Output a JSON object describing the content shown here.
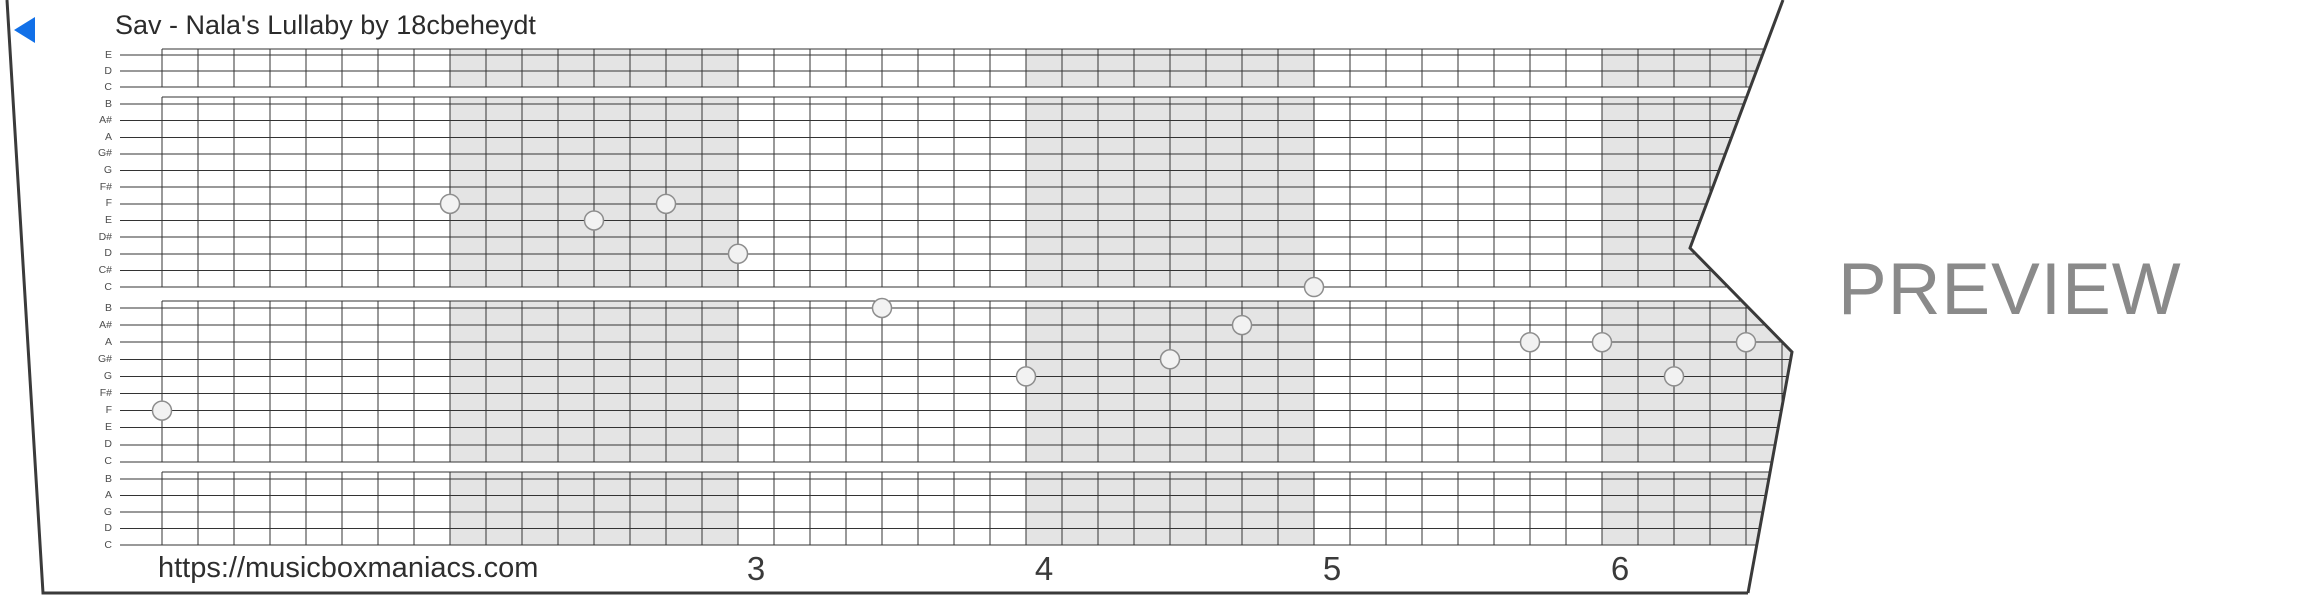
{
  "header": {
    "title": "Sav - Nala's Lullaby by 18cbeheydt"
  },
  "footer": {
    "url": "https://musicboxmaniacs.com",
    "measure_numbers": [
      "3",
      "4",
      "5",
      "6"
    ],
    "first_shown_measure": 3
  },
  "watermark": {
    "label": "PREVIEW"
  },
  "icons": {
    "play_icon": "left-pointing-triangle"
  },
  "colors": {
    "accent_blue": "#1170e8",
    "watermark_gray": "#8a8a8a",
    "shaded_measure": "#e4e4e4",
    "grid_line": "#333333",
    "paper_edge": "#3a3a3a",
    "note_fill": "#f2f2f2",
    "note_stroke": "#8d8d8d",
    "title_text": "#2b2b2b",
    "label_text": "#4d4d4d"
  },
  "grid": {
    "left": 162,
    "col_width": 36,
    "cols_per_measure": 8,
    "measures": 6,
    "right_extent": 1920,
    "label_tick_left": 120,
    "shaded_measures": [
      2,
      4,
      6
    ],
    "sections": [
      {
        "top": 49,
        "first_line": 55,
        "spacing": 16,
        "labels": [
          "E",
          "D",
          "C"
        ]
      },
      {
        "top": 97,
        "first_line": 104,
        "spacing": 16.64,
        "labels": [
          "B",
          "A#",
          "A",
          "G#",
          "G",
          "F#",
          "F",
          "E",
          "D#",
          "D",
          "C#",
          "C"
        ]
      },
      {
        "top": 301,
        "first_line": 308,
        "spacing": 17.1,
        "labels": [
          "B",
          "A#",
          "A",
          "G#",
          "G",
          "F#",
          "F",
          "E",
          "D",
          "C"
        ]
      },
      {
        "top": 472,
        "first_line": 479,
        "spacing": 16.5,
        "labels": [
          "B",
          "A",
          "G",
          "D",
          "C"
        ]
      }
    ]
  },
  "notes": [
    {
      "beat": 0,
      "pitch": "F",
      "section": 2
    },
    {
      "beat": 8,
      "pitch": "F",
      "section": 1
    },
    {
      "beat": 12,
      "pitch": "E",
      "section": 1
    },
    {
      "beat": 14,
      "pitch": "F",
      "section": 1
    },
    {
      "beat": 16,
      "pitch": "D",
      "section": 1
    },
    {
      "beat": 20,
      "pitch": "B",
      "section": 2
    },
    {
      "beat": 24,
      "pitch": "G",
      "section": 2
    },
    {
      "beat": 28,
      "pitch": "G#",
      "section": 2
    },
    {
      "beat": 30,
      "pitch": "A#",
      "section": 2
    },
    {
      "beat": 32,
      "pitch": "C",
      "section": 1
    },
    {
      "beat": 38,
      "pitch": "A",
      "section": 2
    },
    {
      "beat": 40,
      "pitch": "A",
      "section": 2
    },
    {
      "beat": 42,
      "pitch": "G",
      "section": 2
    },
    {
      "beat": 44,
      "pitch": "A",
      "section": 2
    }
  ],
  "paper": {
    "clip_polygon": [
      [
        7,
        0
      ],
      [
        1783,
        0
      ],
      [
        1690,
        248
      ],
      [
        1792,
        352
      ],
      [
        1748,
        593
      ],
      [
        43,
        593
      ]
    ],
    "left_bottom_edge": "M7,0 L43,593 L1748,593",
    "right_edge": "M1783,0 L1690,248 L1792,352 L1748,593",
    "edge_width": 3
  }
}
